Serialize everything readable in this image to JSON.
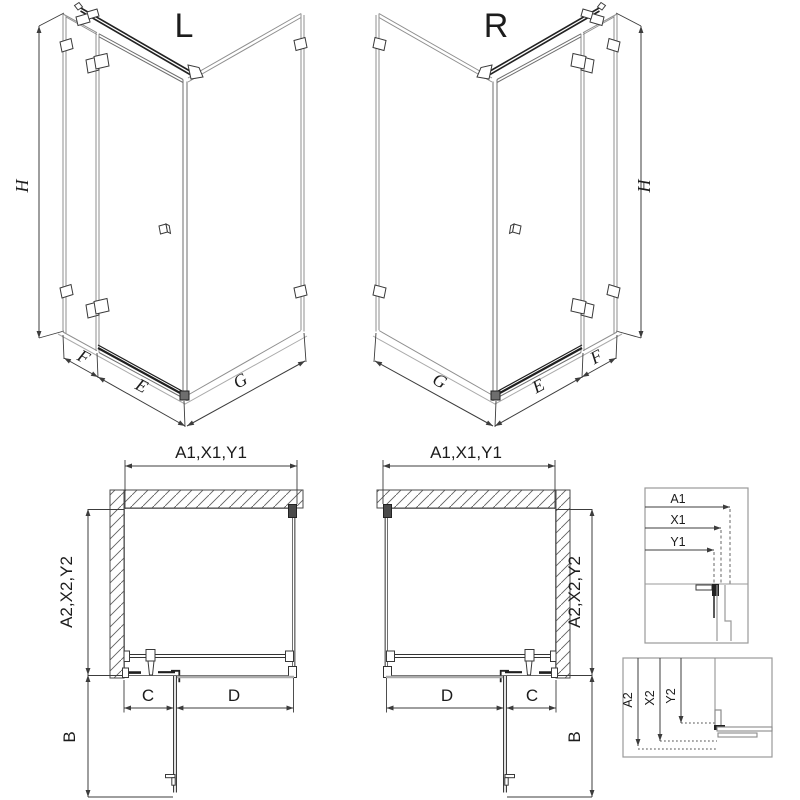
{
  "diagram": {
    "iso_left": {
      "title": "L",
      "height_label": "H",
      "fixed_label": "F",
      "door_label": "E",
      "side_label": "G"
    },
    "iso_right": {
      "title": "R",
      "height_label": "H",
      "fixed_label": "F",
      "door_label": "E",
      "side_label": "G"
    },
    "plan_left": {
      "width_label": "A1,X1,Y1",
      "depth_label": "A2,X2,Y2",
      "c_label": "C",
      "d_label": "D",
      "b_label": "B"
    },
    "plan_right": {
      "width_label": "A1,X1,Y1",
      "depth_label": "A2,X2,Y2",
      "c_label": "C",
      "d_label": "D",
      "b_label": "B"
    },
    "detail_width": {
      "a1": "A1",
      "x1": "X1",
      "y1": "Y1"
    },
    "detail_depth": {
      "a2": "A2",
      "x2": "X2",
      "y2": "Y2"
    },
    "colors": {
      "line": "#3c3c3c",
      "glass": "#8f8f8f",
      "dark": "#1f1f1f",
      "light_gray": "#ababab",
      "box_border": "#9a9a9a",
      "background": "#ffffff"
    }
  }
}
